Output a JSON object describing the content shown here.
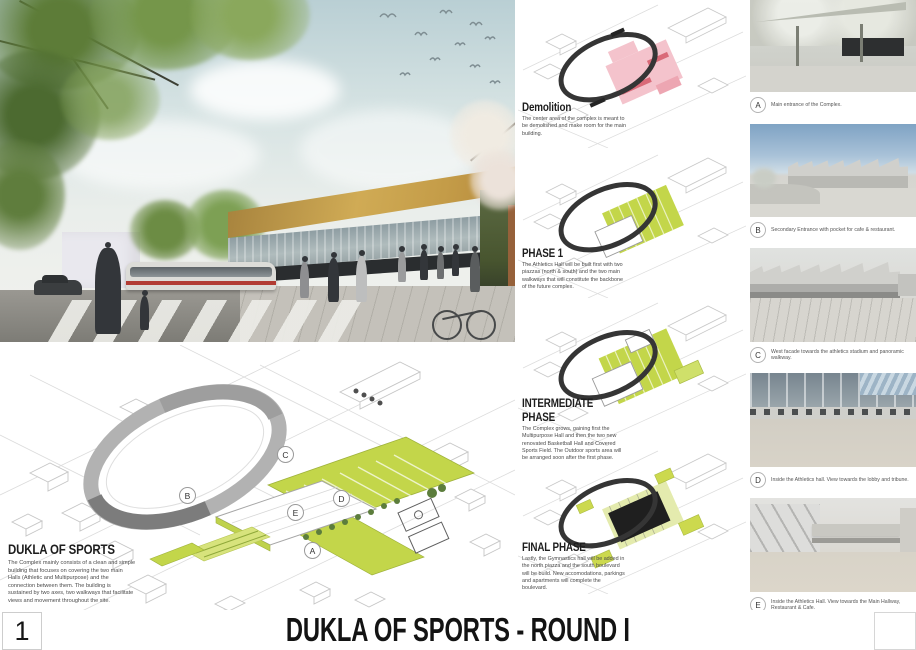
{
  "board": {
    "number": "1",
    "title": "DUKLA OF SPORTS - ROUND I"
  },
  "site_plan": {
    "title": "DUKLA OF SPORTS",
    "description": "The Complex mainly consists of a clean and simple building that focuses on covering the two main Halls (Athletic and Multipurpose) and the connection between them. The building is sustained by two axes, two walkways that facilitate views and movement throughout the site.",
    "markers": [
      "A",
      "B",
      "C",
      "D",
      "E"
    ]
  },
  "phases": [
    {
      "title": "Demolition",
      "description": "The center area of the complex is meant to be demolished and make room for the main building.",
      "highlight_color": "#f4c3cc"
    },
    {
      "title": "PHASE 1",
      "description": "The Athletics Hall will be built first with two piazzas (north & south) and the two main walkways that will constitute the backbone of the future complex.",
      "highlight_color": "#c3d64a"
    },
    {
      "title": "INTERMEDIATE PHASE",
      "description": "The Complex grows, gaining first the Multipurpose Hall and then the two new renovated Basketball Hall and Covered Sports Field. The Outdoor sports area will be arranged soon after the first phase.",
      "highlight_color": "#c3d64a"
    },
    {
      "title": "FINAL PHASE",
      "description": "Lastly, the Gymnastics hall will be added in the north piazza and the south boulevard will be build. New accomodations, parkings and apartments will complete the boulevard.",
      "highlight_color": "#ccd94e"
    }
  ],
  "figures": [
    {
      "label": "A",
      "caption": "Main entrance of the Complex."
    },
    {
      "label": "B",
      "caption": "Secondary Entrance with pocket for cafe & restaurant."
    },
    {
      "label": "C",
      "caption": "West facade towards the athletics stadium and panoramic walkway."
    },
    {
      "label": "D",
      "caption": "Inside the Athletics hall. View towards the lobby and tribune."
    },
    {
      "label": "E",
      "caption": "Inside the Athletics Hall. View towards the Main Hallway, Restaurant & Cafe."
    }
  ],
  "colors": {
    "phase_green": "#c3d64a",
    "demolition_pink": "#f4c3cc",
    "track_gray": "#3b3b3b",
    "roof_gold": "#c9a34e"
  }
}
